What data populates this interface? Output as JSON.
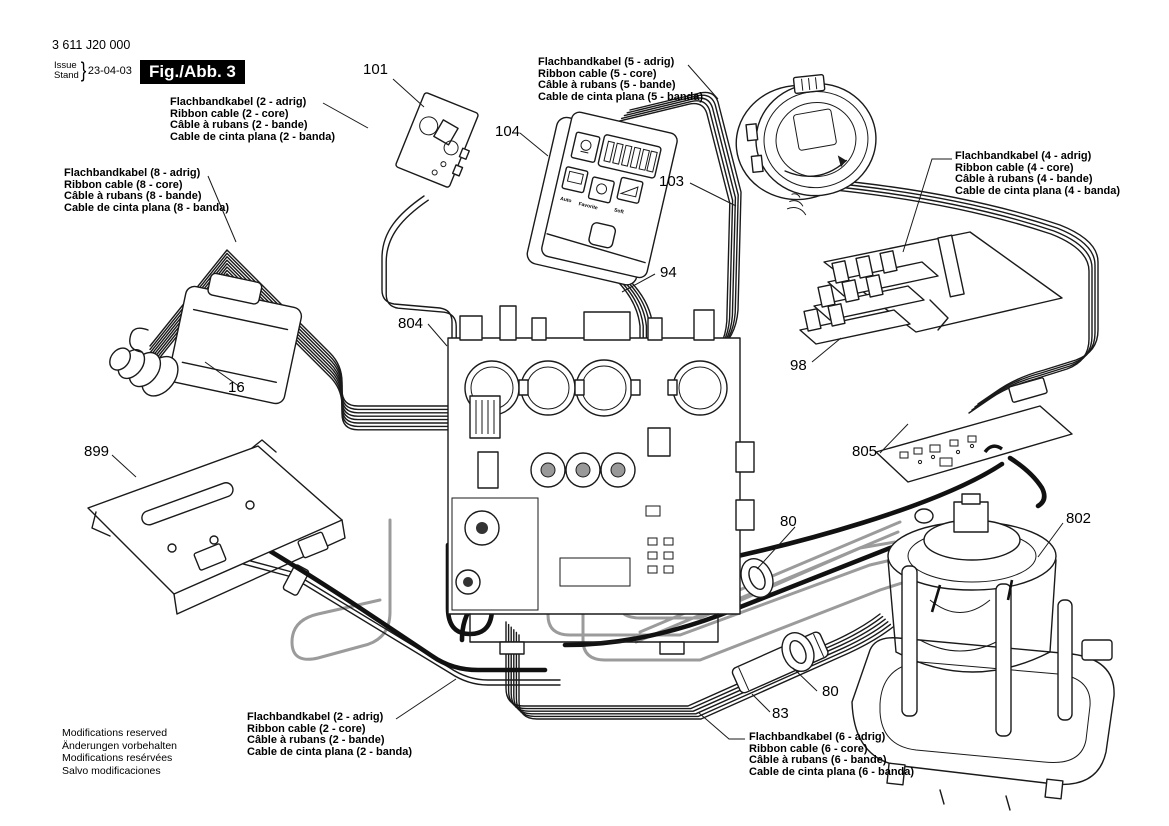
{
  "meta": {
    "part_number": "3 611 J20 000",
    "issue_label": "Issue",
    "stand_label": "Stand",
    "brace": "}",
    "date": "23-04-03",
    "figure_label": "Fig./Abb. 3"
  },
  "cable_labels": {
    "c2_top": {
      "de": "Flachbandkabel (2 - adrig)",
      "en": "Ribbon cable (2 - core)",
      "fr": "Câble à rubans (2 - bande)",
      "es": "Cable de cinta plana (2 - banda)"
    },
    "c5": {
      "de": "Flachbandkabel (5 - adrig)",
      "en": "Ribbon cable (5 - core)",
      "fr": "Câble à rubans (5 - bande)",
      "es": "Cable de cinta plana (5 - banda)"
    },
    "c8": {
      "de": "Flachbandkabel (8 - adrig)",
      "en": "Ribbon cable (8 - core)",
      "fr": "Câble à rubans (8 - bande)",
      "es": "Cable de cinta plana (8 - banda)"
    },
    "c4": {
      "de": "Flachbandkabel (4 - adrig)",
      "en": "Ribbon cable (4 - core)",
      "fr": "Câble à rubans (4 - bande)",
      "es": "Cable de cinta plana (4 - banda)"
    },
    "c2_bottom": {
      "de": "Flachbandkabel (2 - adrig)",
      "en": "Ribbon cable (2 - core)",
      "fr": "Câble à rubans (2 - bande)",
      "es": "Cable de cinta plana (2 - banda)"
    },
    "c6": {
      "de": "Flachbandkabel (6 - adrig)",
      "en": "Ribbon cable (6 - core)",
      "fr": "Câble à rubans (6 - bande)",
      "es": "Cable de cinta plana (6 - banda)"
    }
  },
  "part_numbers": {
    "p101": "101",
    "p104": "104",
    "p103": "103",
    "p94": "94",
    "p804": "804",
    "p16": "16",
    "p899": "899",
    "p98": "98",
    "p805": "805",
    "p80_upper": "80",
    "p80_lower": "80",
    "p802": "802",
    "p83": "83"
  },
  "control_panel": {
    "buttons": [
      "Auto",
      "Favorite",
      "Soft"
    ]
  },
  "footer": {
    "en": "Modifications reserved",
    "de": "Änderungen vorbehalten",
    "fr": "Modifications resérvées",
    "es": "Salvo modificaciones"
  }
}
